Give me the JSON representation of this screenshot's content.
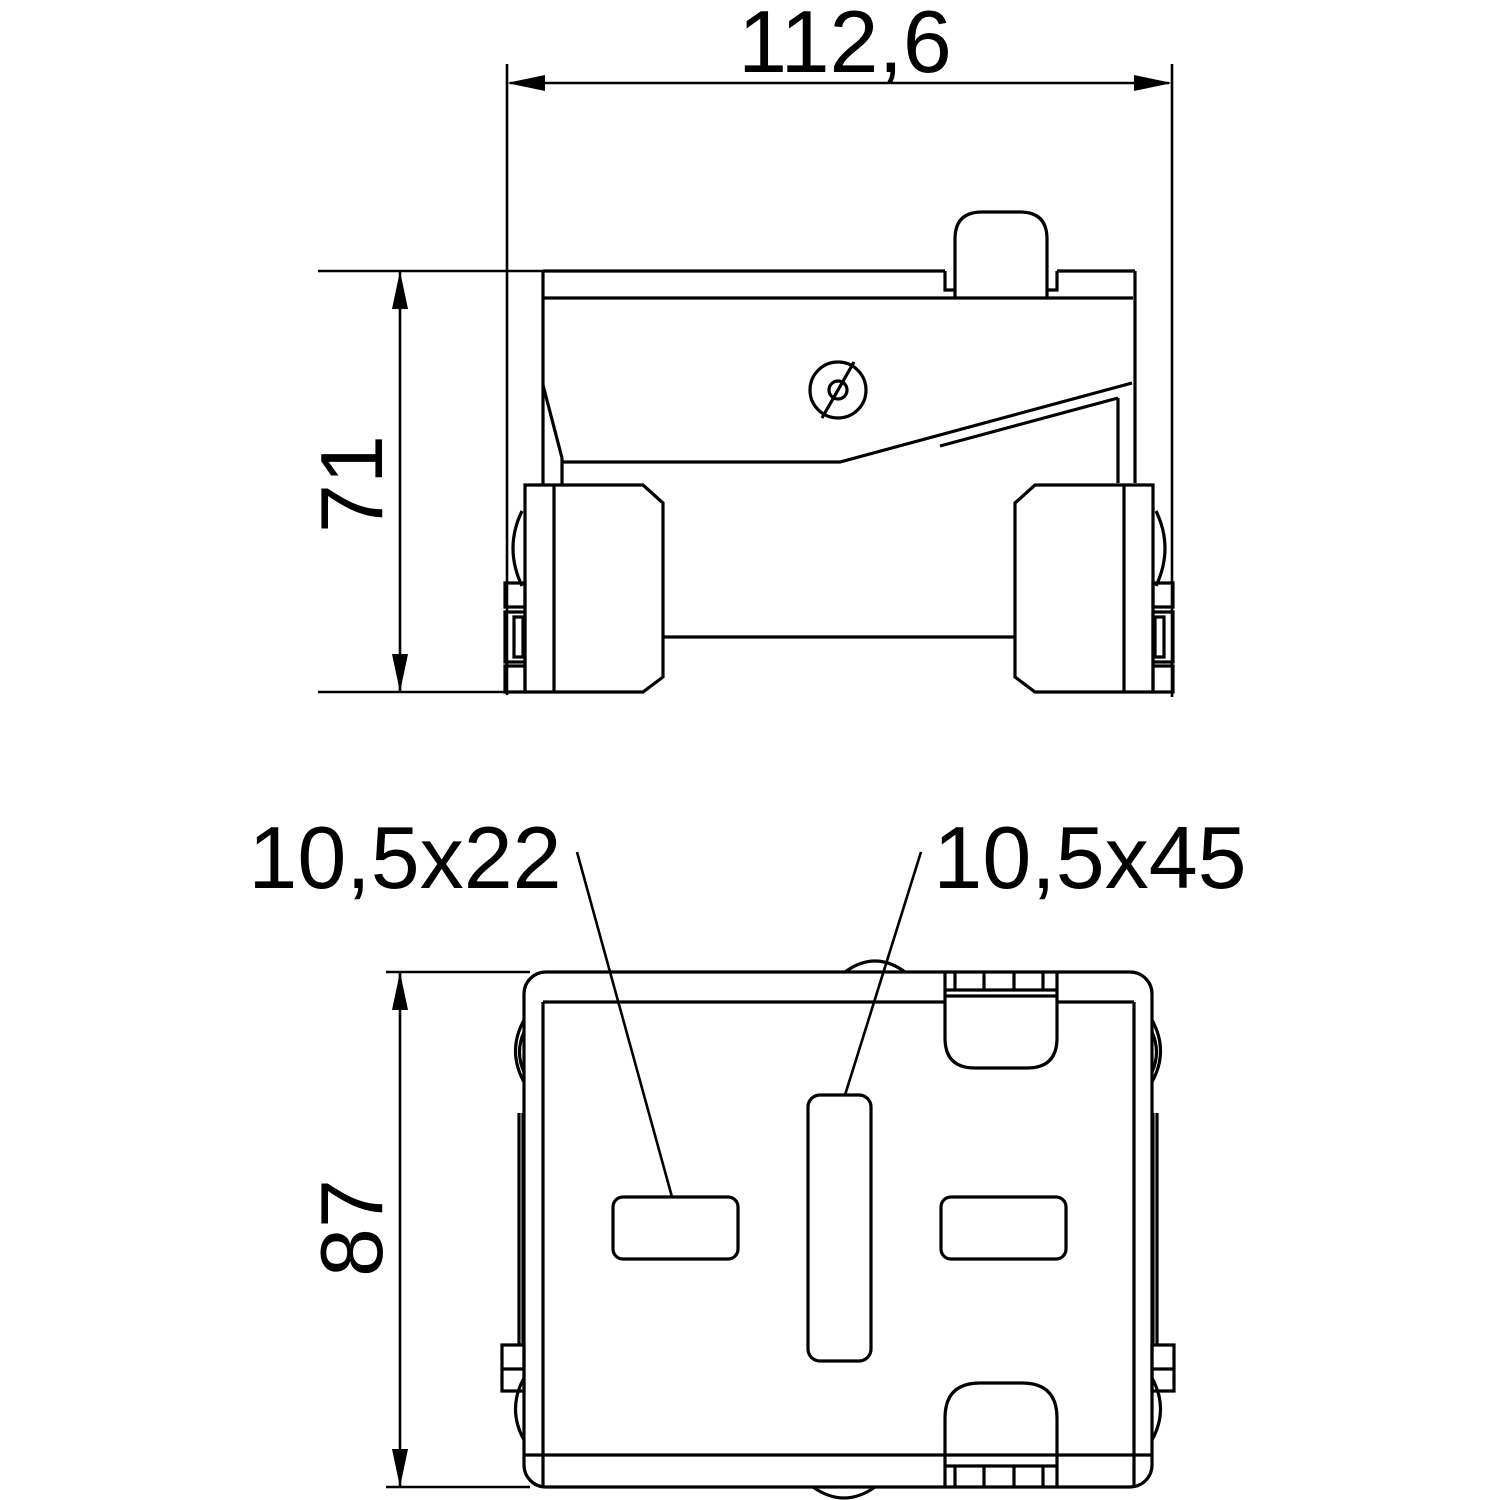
{
  "colors": {
    "line": "#000000",
    "background": "#ffffff"
  },
  "dimensions": {
    "overall_width": "112,6",
    "front_view_height": "71",
    "bottom_view_height": "87"
  },
  "slot_callouts": {
    "side_slot": "10,5x22",
    "center_slot": "10,5x45"
  }
}
